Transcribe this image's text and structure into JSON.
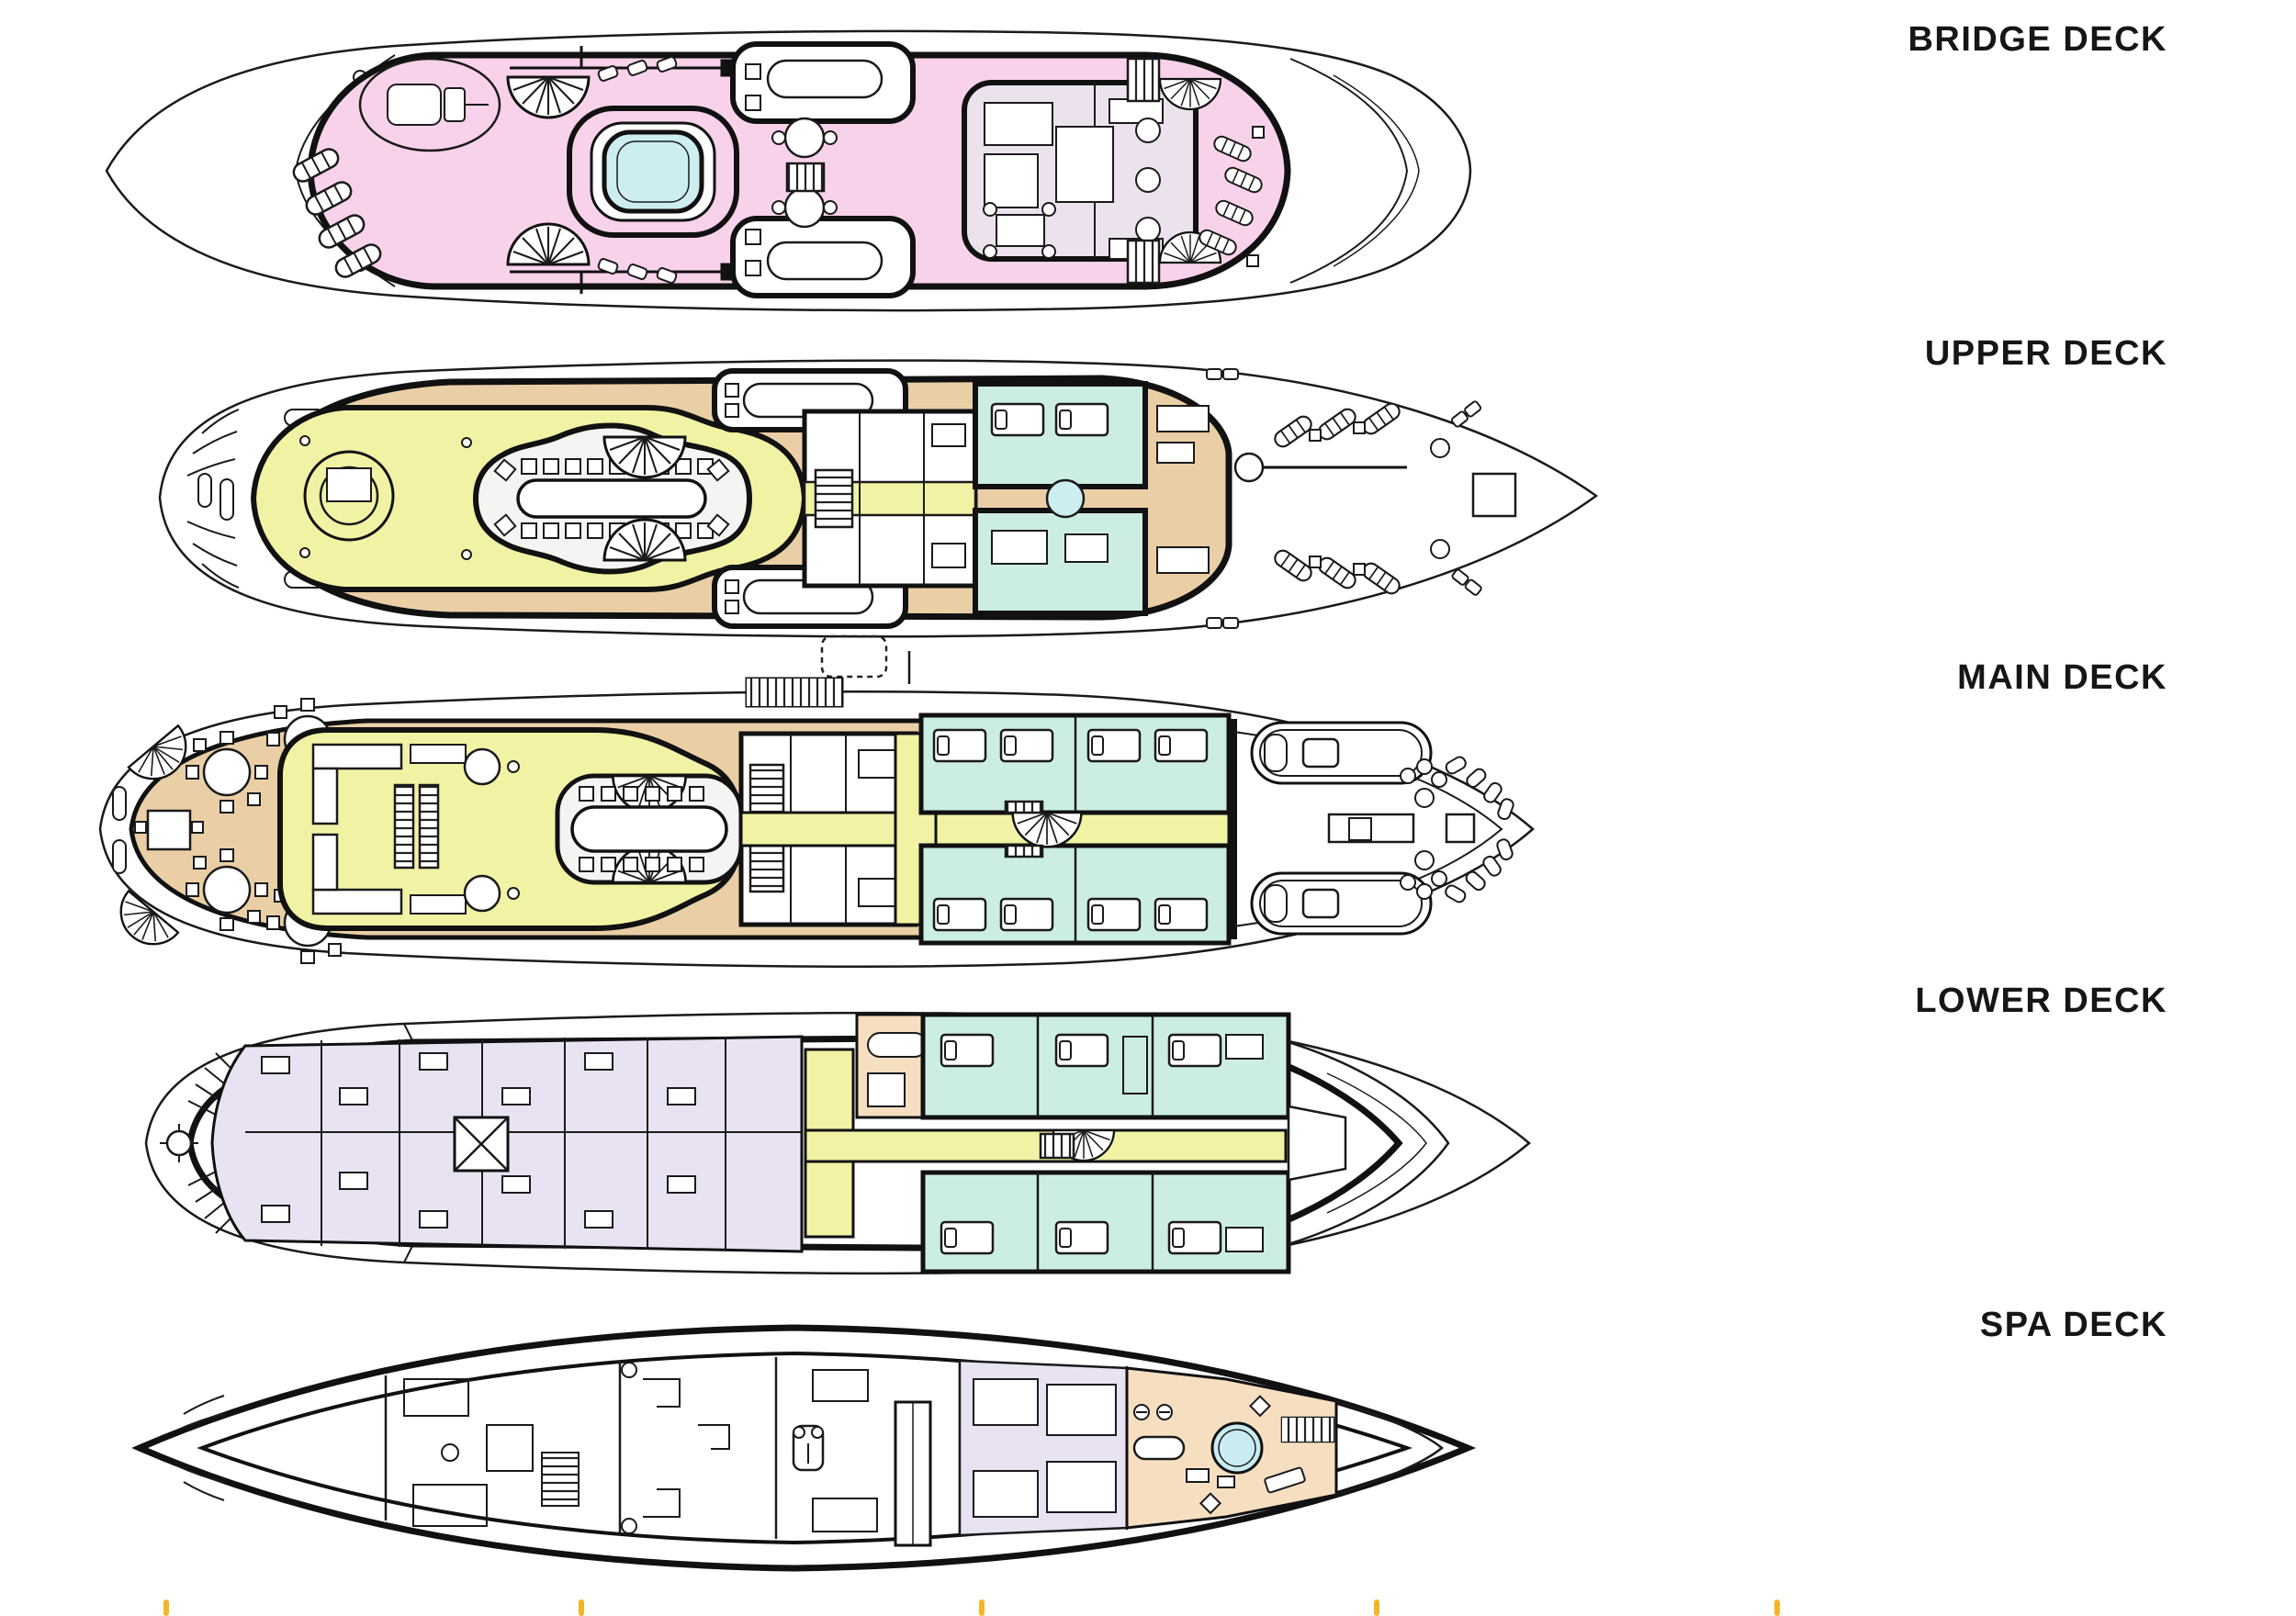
{
  "page": {
    "background": "#ffffff"
  },
  "decks": [
    {
      "id": "bridge-deck",
      "label": "BRIDGE DECK"
    },
    {
      "id": "upper-deck",
      "label": "UPPER DECK"
    },
    {
      "id": "main-deck",
      "label": "MAIN DECK"
    },
    {
      "id": "lower-deck",
      "label": "LOWER DECK"
    },
    {
      "id": "spa-deck",
      "label": "SPA DECK"
    }
  ],
  "colors": {
    "pink": "#f8d2ea",
    "pool": "#cdeef0",
    "spa_pool": "#c9ecf2",
    "tan": "#eacfa6",
    "yellow": "#f1f2a4",
    "mint": "#cceee2",
    "lavender": "#e8e2f3",
    "peach": "#f6dfc1",
    "lounge": "#ece2ee",
    "white_area": "#f4f4f2",
    "outline": "#111111",
    "tick": "#f2b524"
  },
  "footer": {
    "tick_count": 5
  }
}
